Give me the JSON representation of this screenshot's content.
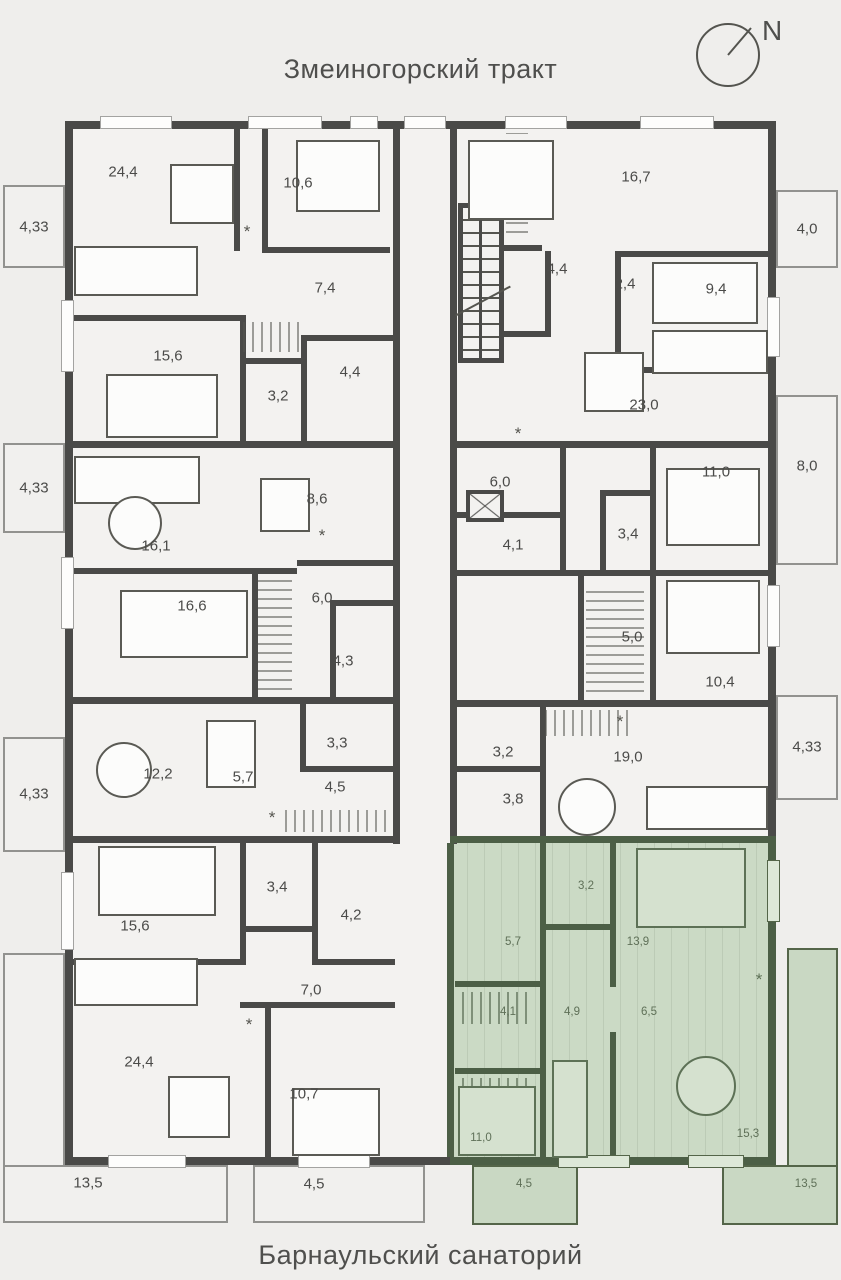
{
  "titles": {
    "top": "Змеиногорский тракт",
    "bottom": "Барнаульский санаторий"
  },
  "compass": {
    "north_label": "N"
  },
  "icons": {
    "washer": "*"
  },
  "colors": {
    "wall": "#4a4a48",
    "highlight_floor": "#cbdac5",
    "highlight_wall": "#4c5f46"
  },
  "apartments": [
    {
      "id": "top-left",
      "highlighted": false,
      "rooms": [
        {
          "name": "living-dining",
          "area": "24,4"
        },
        {
          "name": "bedroom",
          "area": "10,6"
        },
        {
          "name": "hallway",
          "area": "7,4"
        },
        {
          "name": "bedroom",
          "area": "15,6"
        },
        {
          "name": "wc",
          "area": "3,2"
        },
        {
          "name": "bathroom",
          "area": "4,4"
        }
      ]
    },
    {
      "id": "top-right",
      "highlighted": false,
      "rooms": [
        {
          "name": "bedroom",
          "area": "16,7"
        },
        {
          "name": "bathroom",
          "area": "4,4"
        },
        {
          "name": "hallway",
          "area": "2,4"
        },
        {
          "name": "bedroom",
          "area": "9,4"
        },
        {
          "name": "living-kitchen",
          "area": "23,0"
        }
      ]
    },
    {
      "id": "mid-left",
      "highlighted": false,
      "rooms": [
        {
          "name": "living-room",
          "area": "16,1"
        },
        {
          "name": "kitchen",
          "area": "8,6"
        },
        {
          "name": "bedroom",
          "area": "16,6"
        },
        {
          "name": "hallway",
          "area": "6,0"
        },
        {
          "name": "bathroom",
          "area": "4,3"
        }
      ]
    },
    {
      "id": "mid-right",
      "highlighted": false,
      "rooms": [
        {
          "name": "hallway",
          "area": "6,0"
        },
        {
          "name": "bathroom",
          "area": "4,1"
        },
        {
          "name": "wc",
          "area": "3,4"
        },
        {
          "name": "bedroom",
          "area": "11,0"
        },
        {
          "name": "wardrobe",
          "area": "5,0"
        },
        {
          "name": "bedroom",
          "area": "10,4"
        }
      ]
    },
    {
      "id": "lower-mid-left",
      "highlighted": false,
      "rooms": [
        {
          "name": "living-room",
          "area": "12,2"
        },
        {
          "name": "kitchen",
          "area": "5,7"
        },
        {
          "name": "wc",
          "area": "3,3"
        },
        {
          "name": "hallway",
          "area": "4,5"
        }
      ]
    },
    {
      "id": "lower-mid-right-studio",
      "highlighted": false,
      "rooms": [
        {
          "name": "wardrobe",
          "area": "3,2"
        },
        {
          "name": "bathroom",
          "area": "3,8"
        },
        {
          "name": "living-kitchen",
          "area": "19,0"
        }
      ]
    },
    {
      "id": "bottom-left",
      "highlighted": false,
      "rooms": [
        {
          "name": "bedroom",
          "area": "15,6"
        },
        {
          "name": "wc",
          "area": "3,4"
        },
        {
          "name": "bathroom",
          "area": "4,2"
        },
        {
          "name": "hallway",
          "area": "7,0"
        },
        {
          "name": "living-dining",
          "area": "24,4"
        },
        {
          "name": "bedroom",
          "area": "10,7"
        }
      ]
    },
    {
      "id": "bottom-right-highlighted",
      "highlighted": true,
      "rooms": [
        {
          "name": "wardrobe",
          "area": "3,2"
        },
        {
          "name": "bathroom",
          "area": "5,7"
        },
        {
          "name": "bedroom",
          "area": "13,9"
        },
        {
          "name": "wardrobe",
          "area": "4,1"
        },
        {
          "name": "hallway",
          "area": "4,9"
        },
        {
          "name": "kitchen",
          "area": "6,5"
        },
        {
          "name": "bedroom",
          "area": "11,0"
        },
        {
          "name": "living-room",
          "area": "15,3"
        }
      ]
    }
  ],
  "balconies": [
    {
      "side": "left",
      "area": "4,33"
    },
    {
      "side": "left",
      "area": "4,33"
    },
    {
      "side": "left",
      "area": "4,33"
    },
    {
      "side": "right",
      "area": "4,0"
    },
    {
      "side": "right",
      "area": "8,0"
    },
    {
      "side": "right",
      "area": "4,33"
    },
    {
      "side": "bottom",
      "area": "13,5"
    },
    {
      "side": "bottom",
      "area": "4,5"
    },
    {
      "side": "bottom-highlighted",
      "area": "4,5"
    },
    {
      "side": "bottom-highlighted",
      "area": "13,5"
    }
  ]
}
